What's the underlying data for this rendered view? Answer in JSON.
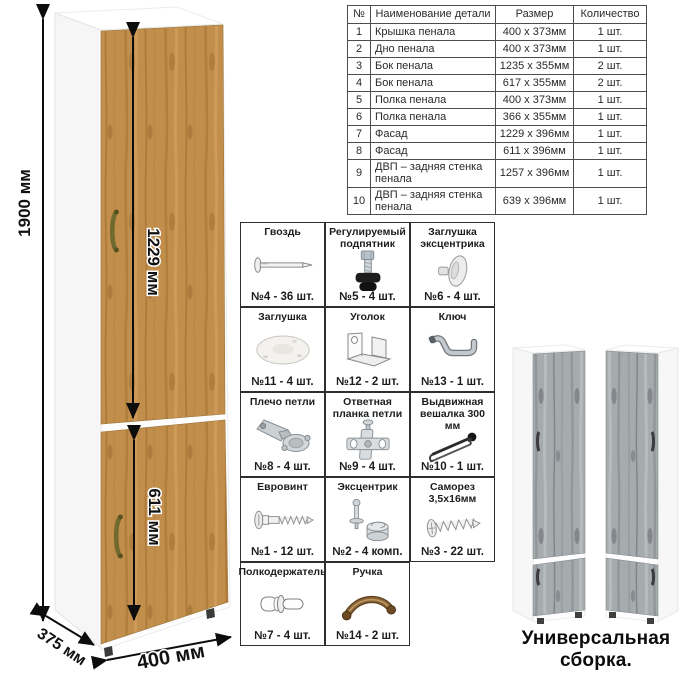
{
  "drawing": {
    "labels": {
      "height": "1900 мм",
      "upper_door": "1229 мм",
      "lower_door": "611 мм",
      "depth": "375 мм",
      "width": "400 мм"
    }
  },
  "parts_table": {
    "headers": [
      "№",
      "Наименование детали",
      "Размер",
      "Количество"
    ],
    "rows": [
      [
        "1",
        "Крышка пенала",
        "400 х 373мм",
        "1 шт."
      ],
      [
        "2",
        "Дно пенала",
        "400 х 373мм",
        "1 шт."
      ],
      [
        "3",
        "Бок пенала",
        "1235 х 355мм",
        "2 шт."
      ],
      [
        "4",
        "Бок пенала",
        "617 х 355мм",
        "2 шт."
      ],
      [
        "5",
        "Полка пенала",
        "400 х 373мм",
        "1 шт."
      ],
      [
        "6",
        "Полка пенала",
        "366 х 355мм",
        "1 шт."
      ],
      [
        "7",
        "Фасад",
        "1229 х 396мм",
        "1 шт."
      ],
      [
        "8",
        "Фасад",
        "611 х 396мм",
        "1 шт."
      ],
      [
        "9",
        "ДВП – задняя стенка пенала",
        "1257 х 396мм",
        "1 шт."
      ],
      [
        "10",
        "ДВП – задняя стенка пенала",
        "639 х 396мм",
        "1 шт."
      ]
    ]
  },
  "hardware": {
    "items": [
      {
        "name": "Гвоздь",
        "count": "№4 - 36 шт.",
        "icon": "nail-icon"
      },
      {
        "name": "Регулируемый подпятник",
        "count": "№5 - 4 шт.",
        "icon": "adjustable-foot-icon"
      },
      {
        "name": "Заглушка эксцентрика",
        "count": "№6 - 4 шт.",
        "icon": "cam-cap-icon"
      },
      {
        "name": "Заглушка",
        "count": "№11 - 4 шт.",
        "icon": "cap-icon"
      },
      {
        "name": "Уголок",
        "count": "№12 - 2 шт.",
        "icon": "corner-bracket-icon"
      },
      {
        "name": "Ключ",
        "count": "№13 - 1 шт.",
        "icon": "key-icon"
      },
      {
        "name": "Плечо петли",
        "count": "№8 - 4 шт.",
        "icon": "hinge-arm-icon"
      },
      {
        "name": "Ответная планка петли",
        "count": "№9 - 4 шт.",
        "icon": "hinge-plate-icon"
      },
      {
        "name": "Выдвижная вешалка 300 мм",
        "count": "№10 - 1 шт.",
        "icon": "pullout-hanger-icon"
      },
      {
        "name": "Евровинт",
        "count": "№1 - 12 шт.",
        "icon": "euroscrew-icon"
      },
      {
        "name": "Эксцентрик",
        "count": "№2 - 4 комп.",
        "icon": "cam-lock-icon"
      },
      {
        "name": "Саморез 3,5х16мм",
        "count": "№3 - 22 шт.",
        "icon": "self-tapping-screw-icon"
      },
      {
        "name": "Полкодержатель",
        "count": "№7 - 4 шт.",
        "icon": "shelf-pin-icon"
      },
      {
        "name": "Ручка",
        "count": "№14 - 2 шт.",
        "icon": "handle-icon"
      }
    ]
  },
  "variants": {
    "caption": "Универсальная сборка."
  },
  "colors": {
    "oak": "#c28e4c",
    "oak_dark": "#a87535",
    "gray_oak": "#a6abae",
    "bronze_handle": "#6f6a2e",
    "table_border": "#4d4d4d",
    "grid_border": "#2e2e2e"
  }
}
